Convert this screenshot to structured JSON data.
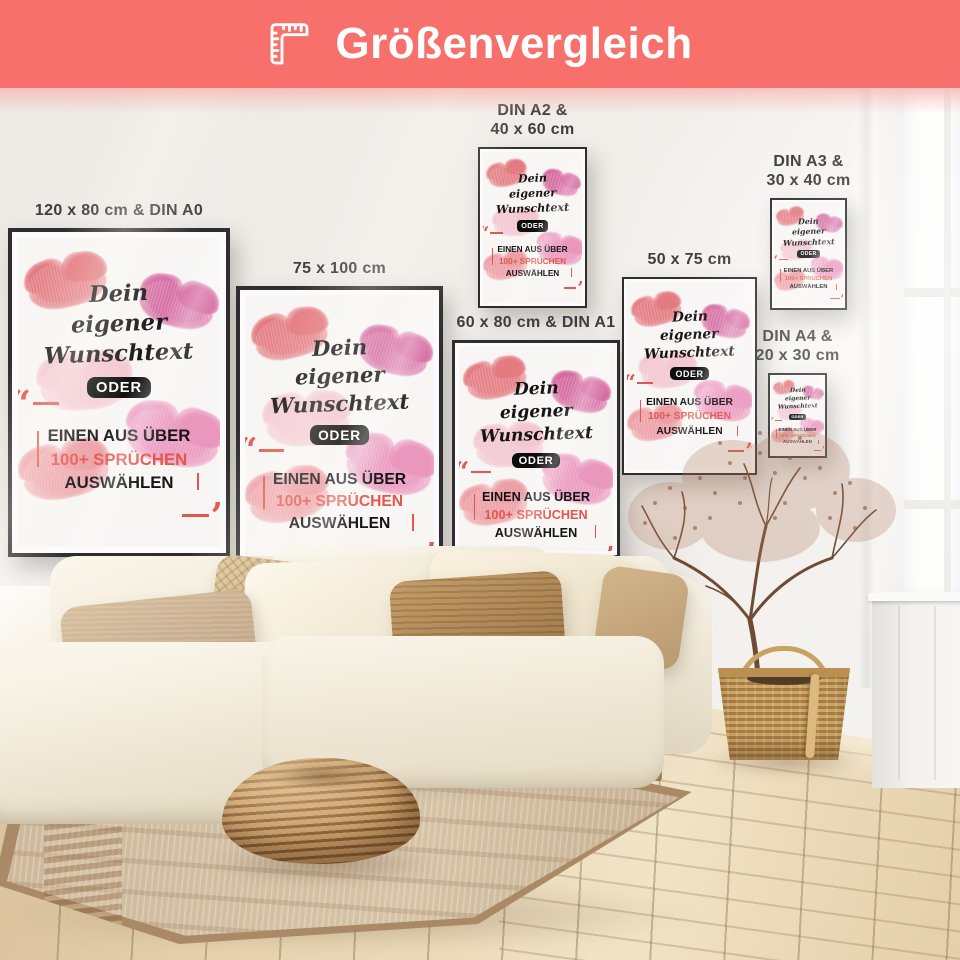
{
  "header": {
    "title": "Größenvergleich",
    "icon": "ruler-icon",
    "background": "#f8706b"
  },
  "palette": {
    "banner": "#f8706b",
    "accent": "#e2574b",
    "label_text": "#3e3e3e",
    "frame": "#2e2e30"
  },
  "artwork": {
    "script1": "Dein",
    "script2": "eigener",
    "script3": "Wunschtext",
    "badge": "ODER",
    "line1": "EINEN AUS ÜBER",
    "line2": "100+ SPRÜCHEN",
    "line3": "AUSWÄHLEN",
    "quote_open": "“",
    "quote_close": "”"
  },
  "posters": [
    {
      "id": "din-a0",
      "label_lines": [
        "120 x 80 cm & DIN A0"
      ],
      "x": 8,
      "y": 228,
      "w": 222,
      "h": 329
    },
    {
      "id": "75x100",
      "label_lines": [
        "75 x 100 cm"
      ],
      "x": 236,
      "y": 286,
      "w": 207,
      "h": 281
    },
    {
      "id": "din-a2",
      "label_lines": [
        "DIN A2 &",
        "40 x 60 cm"
      ],
      "x": 478,
      "y": 147,
      "w": 109,
      "h": 161
    },
    {
      "id": "din-a1",
      "label_lines": [
        "60 x 80 cm & DIN A1"
      ],
      "x": 452,
      "y": 340,
      "w": 168,
      "h": 218
    },
    {
      "id": "50x75",
      "label_lines": [
        "50 x 75 cm"
      ],
      "x": 622,
      "y": 277,
      "w": 135,
      "h": 198
    },
    {
      "id": "din-a3",
      "label_lines": [
        "DIN A3 &",
        "30 x 40 cm"
      ],
      "x": 770,
      "y": 198,
      "w": 77,
      "h": 112
    },
    {
      "id": "din-a4",
      "label_lines": [
        "DIN A4 &",
        "20 x 30 cm"
      ],
      "x": 768,
      "y": 373,
      "w": 59,
      "h": 85
    }
  ]
}
